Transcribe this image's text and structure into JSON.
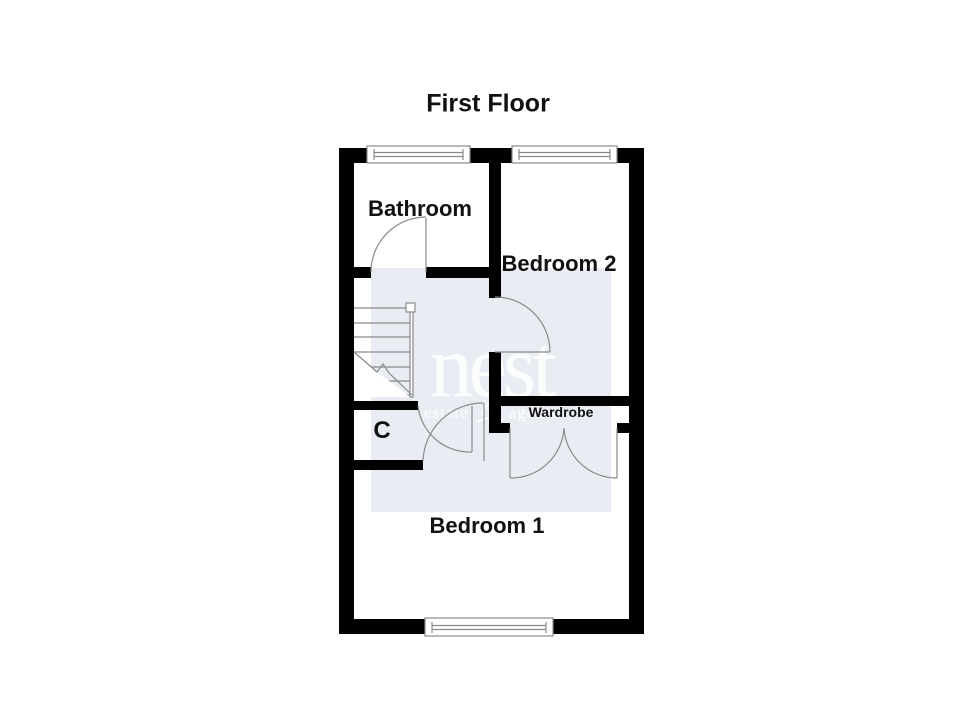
{
  "title": "First Floor",
  "rooms": {
    "bathroom": {
      "label": "Bathroom"
    },
    "bedroom2": {
      "label": "Bedroom 2"
    },
    "bedroom1": {
      "label": "Bedroom 1"
    },
    "cupboard": {
      "label": "C"
    },
    "wardrobe": {
      "label": "Wardrobe"
    }
  },
  "watermark": {
    "brand": "nest",
    "tagline_left": "estate",
    "tagline_right": "agents",
    "icon": "nest-bird-icon",
    "box_color": "#e9edf3",
    "text_color": "#ffffff"
  },
  "colors": {
    "bg": "#ffffff",
    "wall": "#000000",
    "line": "#8a8a8a",
    "label": "#111111"
  }
}
